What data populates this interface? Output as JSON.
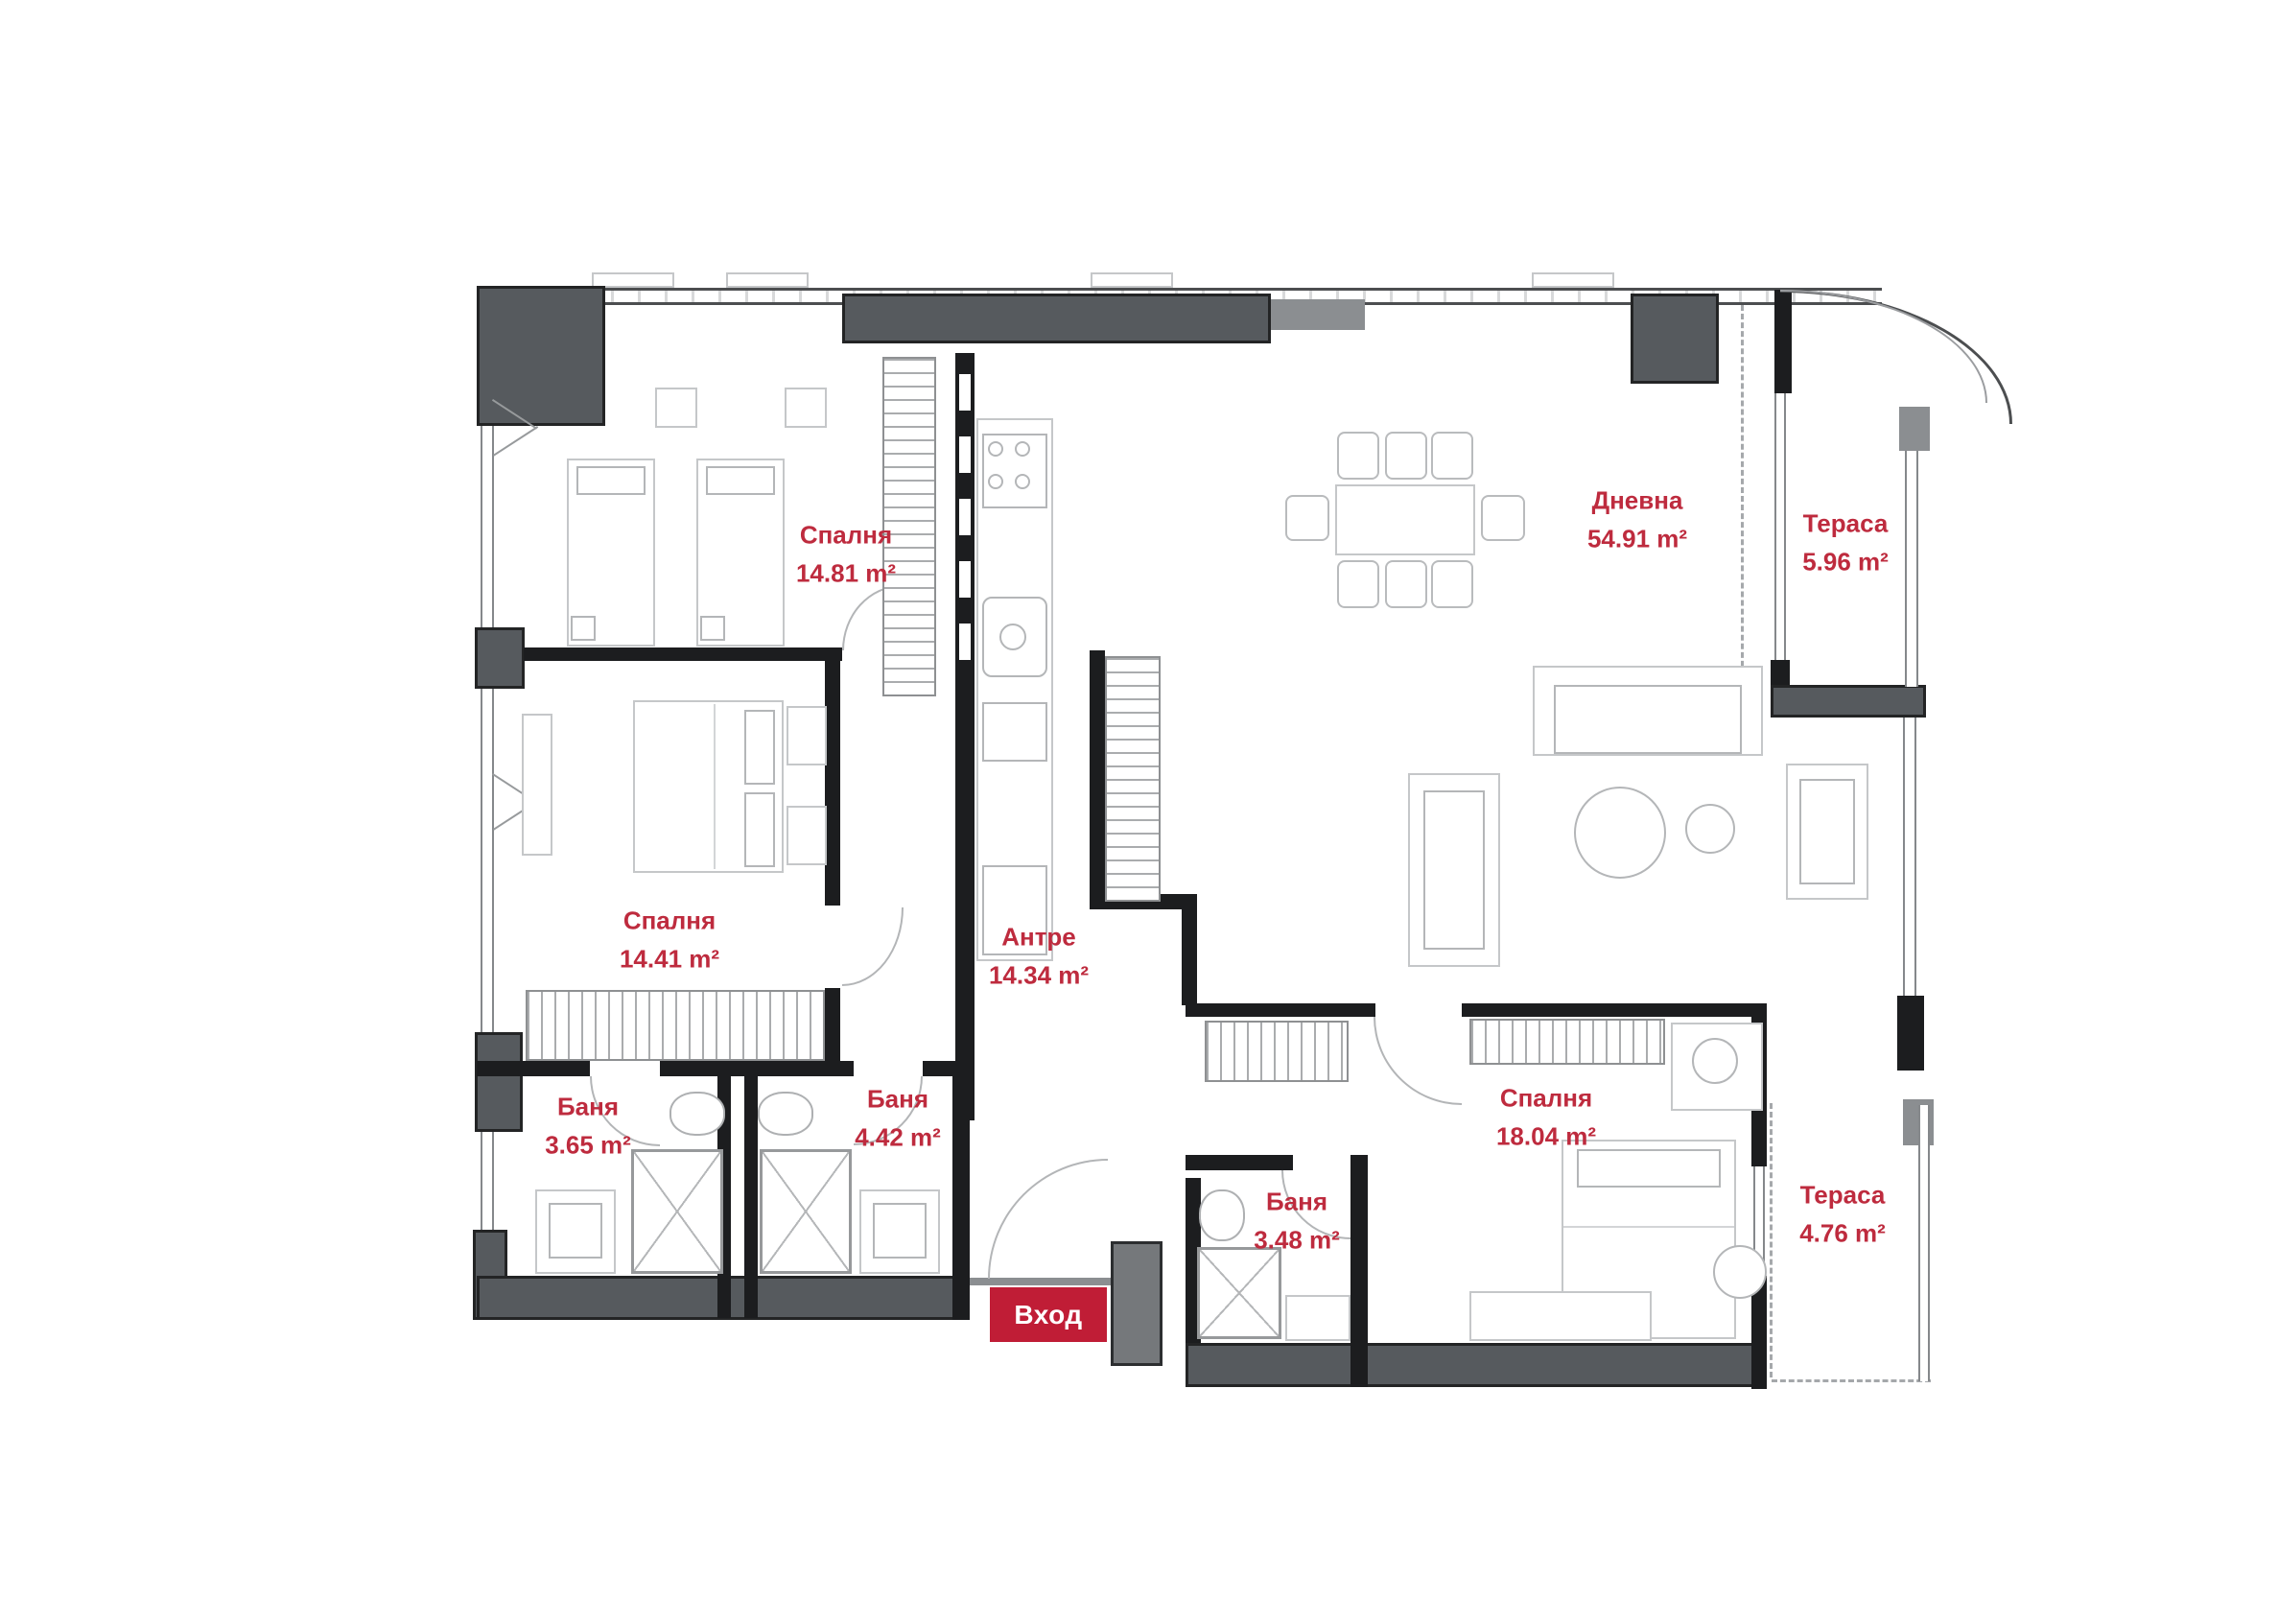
{
  "plan": {
    "type": "apartment-floor-plan",
    "language": "bg",
    "total_rooms_labeled": 10
  },
  "colors": {
    "label_red": "#be2b3e",
    "entrance_badge_red": "#c01d36",
    "wall_dark_grey": "#565a5e",
    "wall_black": "#1c1d1f",
    "window_grey": "#85888b",
    "furniture_grey": "#c5c7c9",
    "background": "#ffffff"
  },
  "rooms": [
    {
      "id": "bedroom-1",
      "name": "Спалня",
      "area": "14.81 m²"
    },
    {
      "id": "living-room",
      "name": "Дневна",
      "area": "54.91 m²"
    },
    {
      "id": "terrace-1",
      "name": "Тераса",
      "area": "5.96 m²"
    },
    {
      "id": "bedroom-2",
      "name": "Спалня",
      "area": "14.41 m²"
    },
    {
      "id": "hallway",
      "name": "Антре",
      "area": "14.34 m²"
    },
    {
      "id": "bathroom-1",
      "name": "Баня",
      "area": "3.65 m²"
    },
    {
      "id": "bathroom-2",
      "name": "Баня",
      "area": "4.42 m²"
    },
    {
      "id": "bathroom-3",
      "name": "Баня",
      "area": "3.48 m²"
    },
    {
      "id": "bedroom-3",
      "name": "Спалня",
      "area": "18.04 m²"
    },
    {
      "id": "terrace-2",
      "name": "Тераса",
      "area": "4.76 m²"
    }
  ],
  "entrance": {
    "label": "Вход"
  }
}
